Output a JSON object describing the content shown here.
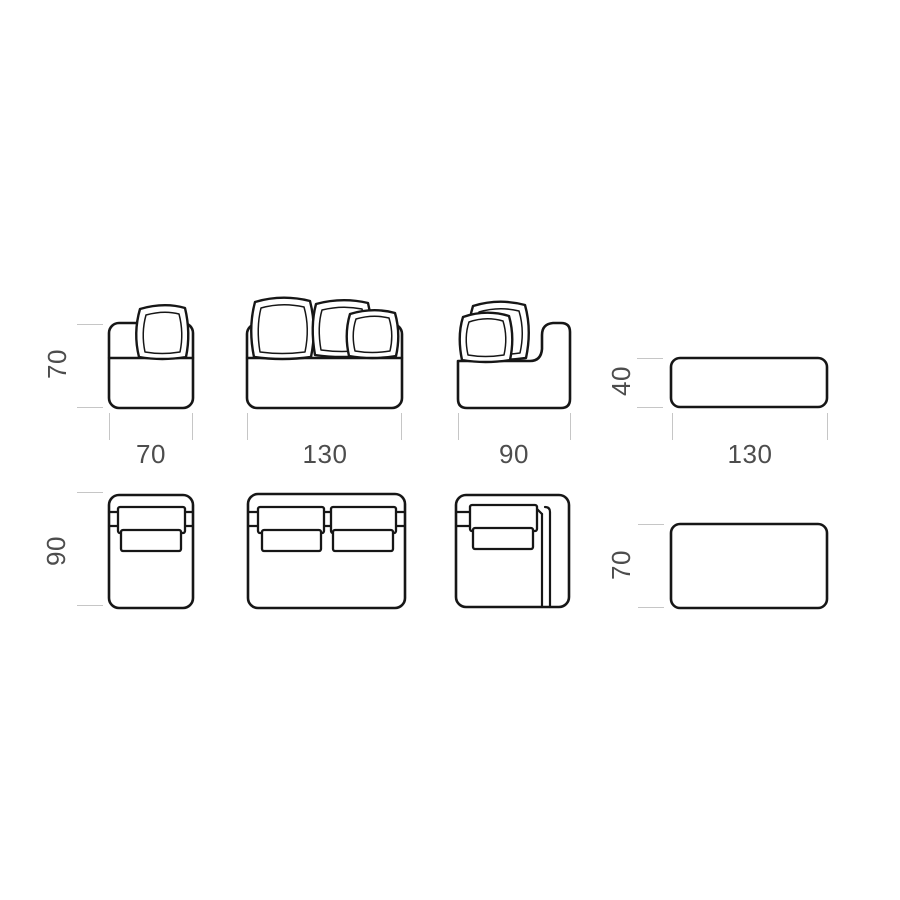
{
  "figure": {
    "background": "#ffffff",
    "colors": {
      "outline": "#161616",
      "dim_tick": "#c6c6c6",
      "dim_text": "#4d4d4d"
    }
  },
  "dimensions": {
    "module_small_front": {
      "height": "70",
      "width": "70"
    },
    "module_large_front": {
      "width": "130"
    },
    "module_corner_front": {
      "width": "90"
    },
    "ottoman_front": {
      "height": "40",
      "width": "130"
    },
    "module_small_top": {
      "depth": "90"
    },
    "ottoman_top": {
      "depth": "70"
    }
  },
  "modules": [
    {
      "view": "front",
      "type": "armless-single-module",
      "width": "70",
      "height": "70",
      "pillows": 1
    },
    {
      "view": "front",
      "type": "armless-double-module",
      "width": "130",
      "pillows": 3
    },
    {
      "view": "front",
      "type": "corner-end-module",
      "width": "90",
      "pillows": 2
    },
    {
      "view": "front",
      "type": "ottoman",
      "width": "130",
      "height": "40"
    },
    {
      "view": "top",
      "type": "armless-single-module",
      "depth": "90"
    },
    {
      "view": "top",
      "type": "armless-double-module"
    },
    {
      "view": "top",
      "type": "corner-end-module"
    },
    {
      "view": "top",
      "type": "ottoman",
      "depth": "70"
    }
  ]
}
